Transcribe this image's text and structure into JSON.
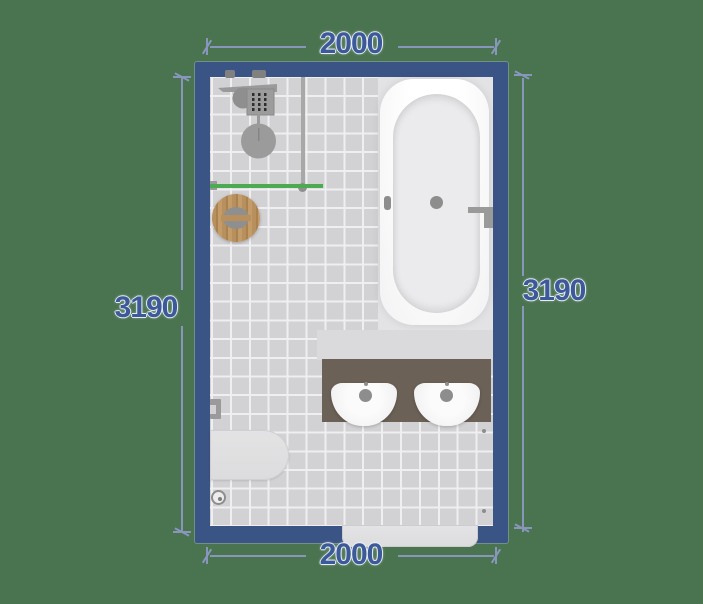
{
  "scene": {
    "type": "bathroom-floorplan-top-view",
    "room": {
      "width_label_top": "2000",
      "width_label_bottom": "2000",
      "height_label_left": "3190",
      "height_label_right": "3190"
    },
    "fixtures": [
      {
        "name": "shower-set"
      },
      {
        "name": "shower-glass-panel"
      },
      {
        "name": "shower-partition-highlighted"
      },
      {
        "name": "wooden-stool"
      },
      {
        "name": "bathtub"
      },
      {
        "name": "double-washbasin-vanity"
      },
      {
        "name": "toilet"
      },
      {
        "name": "toilet-paper-holder"
      },
      {
        "name": "floor-drain"
      },
      {
        "name": "entry-door"
      }
    ],
    "colors": {
      "background": "#4a7350",
      "wall": "#3b5486",
      "dimension_text": "#3c5a9a",
      "dimension_line": "#8896bc",
      "floor_tile": "#d2d2d4",
      "tile_grout": "#efeff1",
      "bathtub_zone": "#e3e3e5",
      "vanity_counter": "#6c6156",
      "stool_wood": "#b7905d",
      "partition_highlight_green": "#4cab50"
    }
  }
}
